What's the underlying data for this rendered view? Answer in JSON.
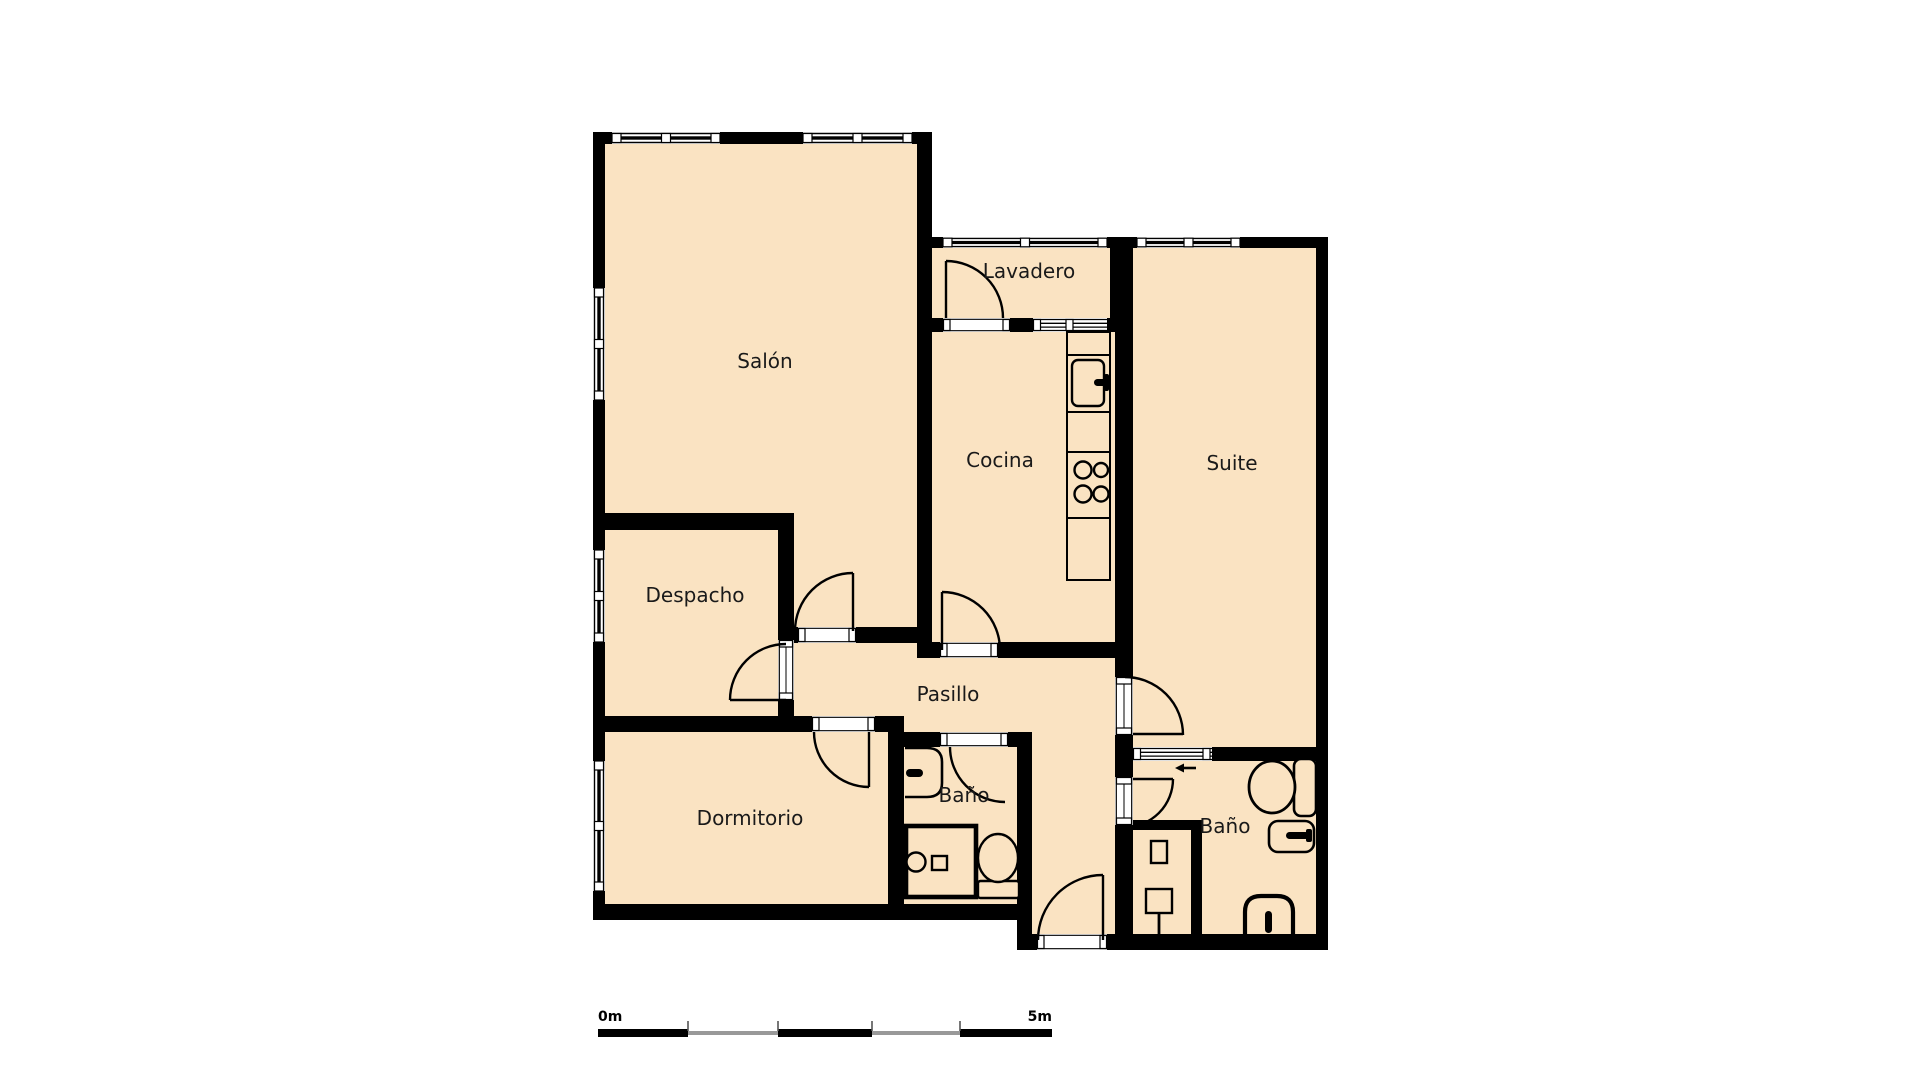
{
  "document": {
    "type": "floor-plan",
    "language": "es"
  },
  "rooms": {
    "salon": {
      "label": "Salón"
    },
    "lavadero": {
      "label": "Lavadero"
    },
    "cocina": {
      "label": "Cocina"
    },
    "suite": {
      "label": "Suite"
    },
    "despacho": {
      "label": "Despacho"
    },
    "pasillo": {
      "label": "Pasillo"
    },
    "dormitorio": {
      "label": "Dormitorio"
    },
    "bano_pasillo": {
      "label": "Baño"
    },
    "bano_suite": {
      "label": "Baño"
    }
  },
  "scale_bar": {
    "start_label": "0m",
    "end_label": "5m",
    "segments": 5
  },
  "colors": {
    "background": "#ffffff",
    "floor": "#fae3c2",
    "wall": "#000000",
    "label": "#1a1a1a",
    "scale_secondary": "#999999"
  },
  "fixtures": [
    "kitchen-sink",
    "stove-4-burners",
    "kitchen-counter",
    "bathroom1-sink",
    "bathroom1-shower",
    "bathroom1-toilet",
    "bathroom2-shower",
    "bathroom2-toilet",
    "bathroom2-sink",
    "bathroom2-bidet",
    "entry-direction-arrow"
  ]
}
